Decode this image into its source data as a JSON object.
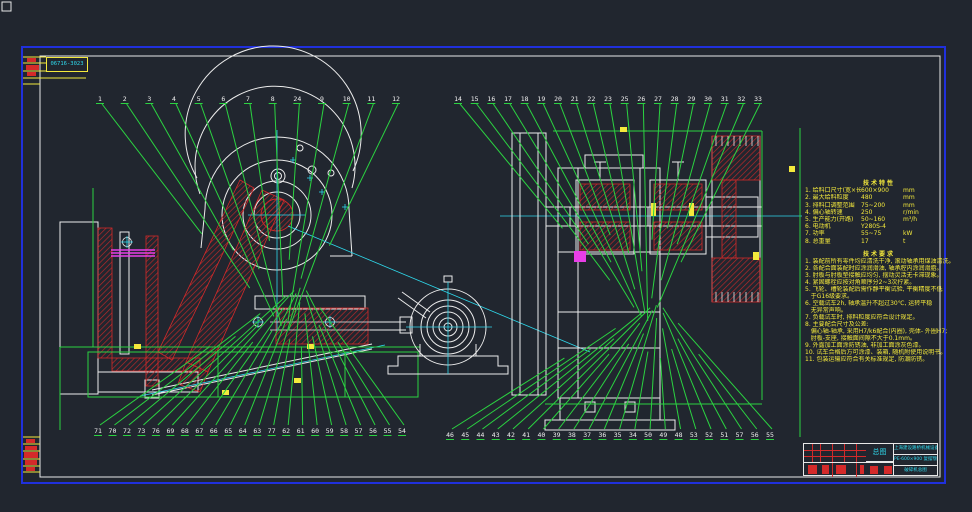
{
  "stamp": {
    "code": "06716-3023"
  },
  "part_rows": {
    "top_left": [
      "1",
      "2",
      "3",
      "4",
      "5",
      "6",
      "7",
      "8",
      "24",
      "9",
      "10",
      "11",
      "12"
    ],
    "top_right": [
      "14",
      "15",
      "16",
      "17",
      "18",
      "19",
      "20",
      "21",
      "22",
      "23",
      "25",
      "26",
      "27",
      "28",
      "29",
      "30",
      "31",
      "32",
      "33"
    ],
    "bottom_left": [
      "71",
      "70",
      "72",
      "73",
      "76",
      "69",
      "68",
      "67",
      "66",
      "65",
      "64",
      "63",
      "77",
      "62",
      "61",
      "60",
      "59",
      "58",
      "57",
      "56",
      "55",
      "54"
    ],
    "bottom_right": [
      "46",
      "45",
      "44",
      "43",
      "42",
      "41",
      "40",
      "39",
      "38",
      "37",
      "36",
      "35",
      "34",
      "50",
      "49",
      "48",
      "53",
      "52",
      "51",
      "57",
      "56",
      "55"
    ]
  },
  "notes": {
    "spec_title": "技术特性",
    "spec_rows": [
      {
        "label": "1. 给料口尺寸(宽×长)",
        "value": "600×900",
        "unit": "mm"
      },
      {
        "label": "2. 最大给料粒度",
        "value": "480",
        "unit": "mm"
      },
      {
        "label": "3. 排料口调整范围",
        "value": "75~200",
        "unit": "mm"
      },
      {
        "label": "4. 偏心轴转速",
        "value": "250",
        "unit": "r/min"
      },
      {
        "label": "5. 生产能力(开路)",
        "value": "50~160",
        "unit": "m³/h"
      },
      {
        "label": "6. 电动机",
        "value": "Y280S-4",
        "unit": ""
      },
      {
        "label": "7. 功率",
        "value": "55~75",
        "unit": "kW"
      },
      {
        "label": "8. 总重量",
        "value": "17",
        "unit": "t"
      }
    ],
    "req_title": "技术要求",
    "req_lines": [
      "1. 装配前所有零件均应清洗干净, 滚动轴承用煤油清洗。",
      "2. 各配合面装配时应涂润滑油, 轴承腔内涂润滑脂。",
      "3. 肘板与肘板垫接触应均匀, 摆动灵活无卡滞现象。",
      "4. 紧固螺栓应按对角顺序分2~3次拧紧。",
      "5. 飞轮、槽轮装配后需作静平衡试验, 平衡精度不低",
      "   于G16级要求。",
      "6. 空载试车2h, 轴承温升不超过30℃, 运转平稳",
      "   无异常声响。",
      "7. 负载试车时, 排料粒度应符合设计规定。",
      "8. 主要配合尺寸及公差:",
      "   偏心轴-轴承, 采用H7/k6配合(内圈), 壳体- 外圈H7;",
      "   肘板-支座, 接触面间隙不大于0.1mm。",
      "9. 外露加工面涂防锈油, 非加工面涂灰色漆。",
      "10. 试车合格后方可涂漆、装箱, 随机附使用说明书。",
      "11. 包装运输应符合有关标准规定, 防潮防锈。"
    ]
  },
  "title_block": {
    "mid_label": "总图",
    "company": "上海建设路桥机械设备有限公司",
    "model_line": "PE-600×900 复摆颚式",
    "drawing_title": "破碎机总图"
  },
  "colors": {
    "frame_blue": "#2030dd",
    "line_green": "#2bd341",
    "draw_red": "#d42a2a",
    "center_cyan": "#2fd9ec",
    "note_yellow": "#f4e93c",
    "magenta": "#e83ee8"
  }
}
